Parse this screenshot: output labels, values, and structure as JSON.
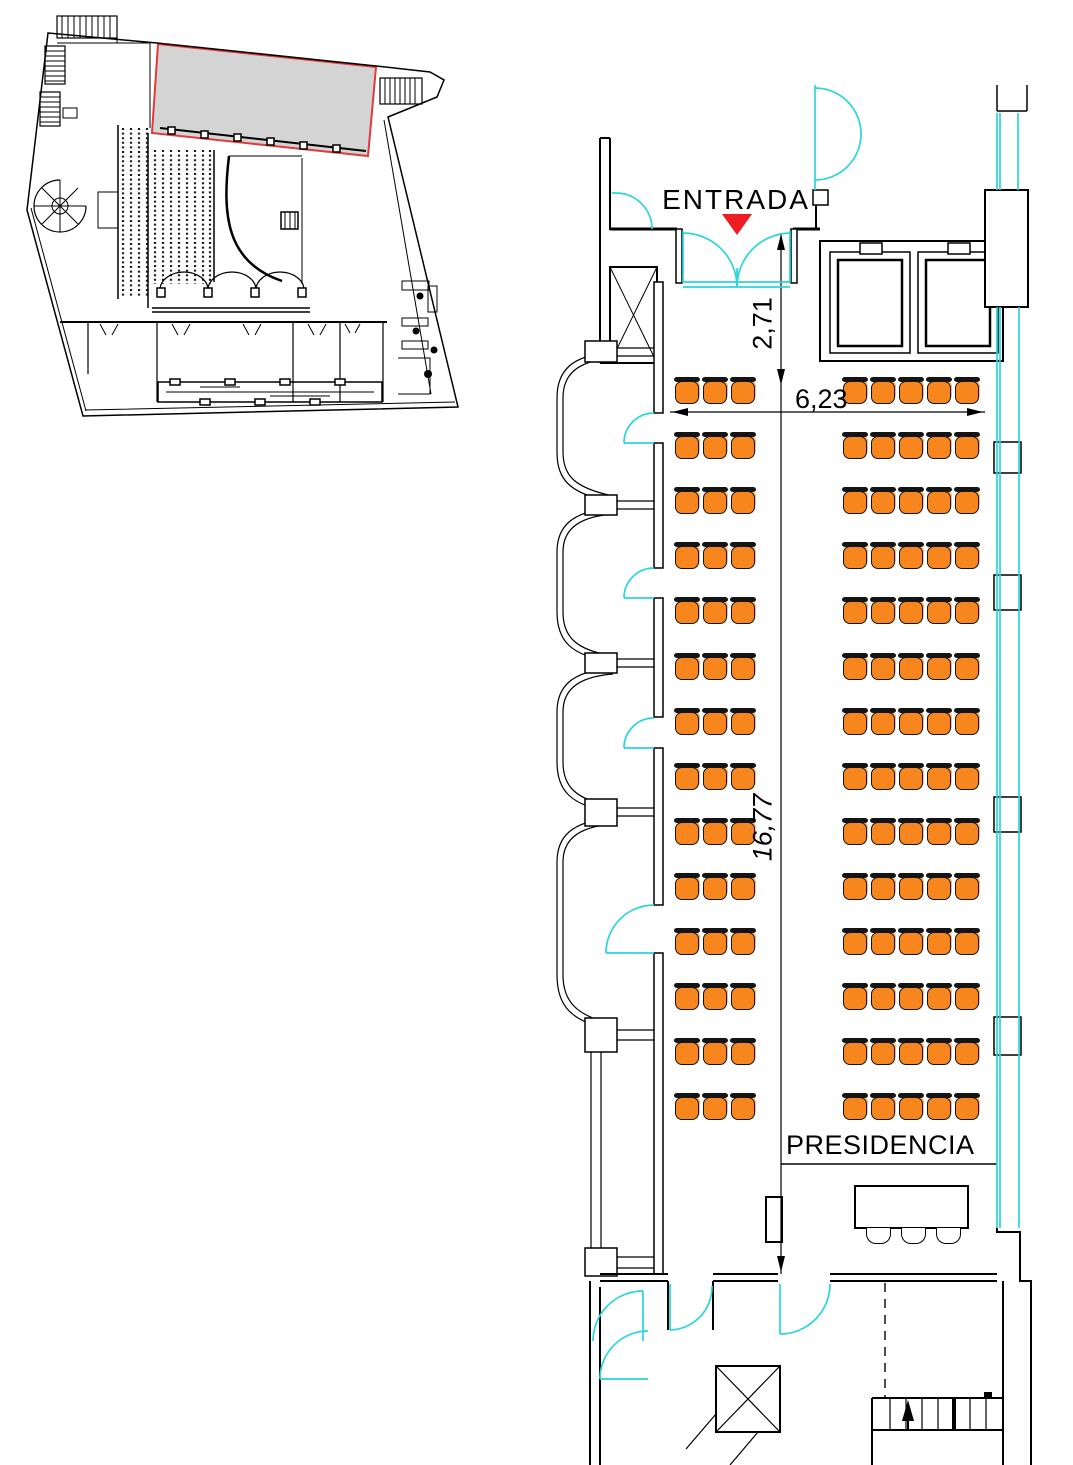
{
  "labels": {
    "entrada": "ENTRADA",
    "presidencia": "PRESIDENCIA"
  },
  "dimensions": {
    "entrance_depth_m": "2,71",
    "hall_width_m": "6,23",
    "hall_length_m": "16,77"
  },
  "colors": {
    "seat_fill": "#F6861D",
    "seat_highlight": "#FDBE6E",
    "door_glazing": "#2BD5DC",
    "entrance_marker_red": "#EE1C23",
    "overview_highlight_fill": "#D4D4D4",
    "overview_highlight_outline": "#E03A3C",
    "linework": "#000000"
  },
  "seating": {
    "left_block": {
      "rows": 14,
      "seats_per_row": 3
    },
    "right_block": {
      "rows": 14,
      "seats_per_row": 5
    },
    "head_table_chairs": 3
  }
}
